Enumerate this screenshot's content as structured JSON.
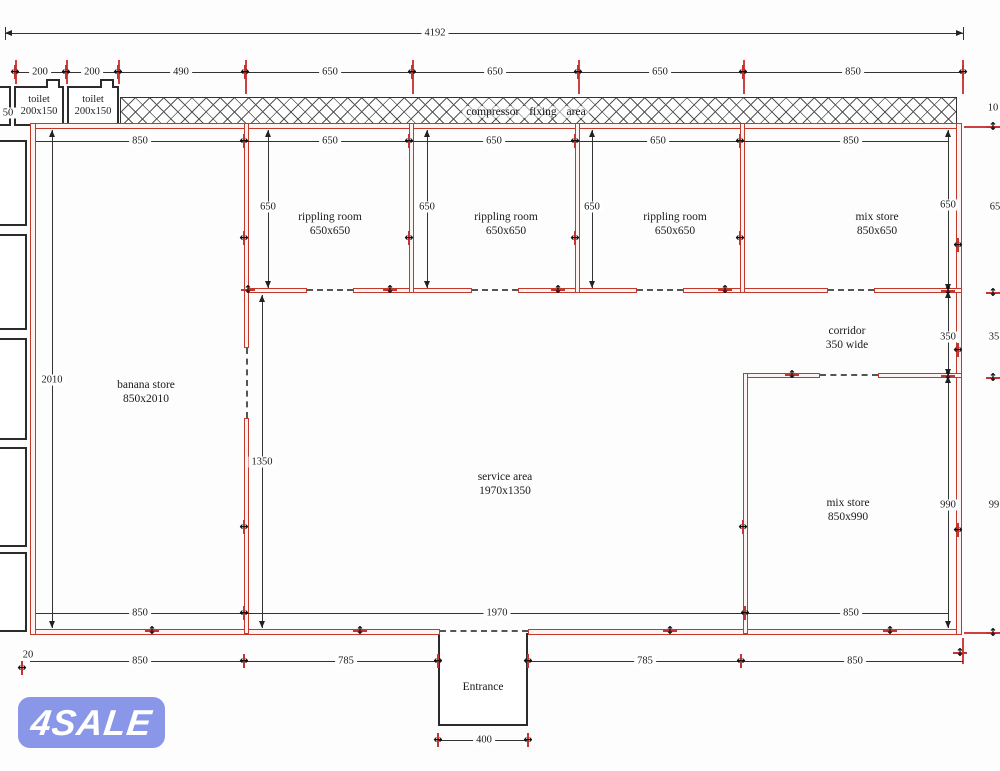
{
  "labels": {
    "compressor_area": "compressor  fixing  area",
    "entrance": "Entrance",
    "toilet_name": "toilet",
    "toilet_size": "200x150"
  },
  "rooms": [
    {
      "id": "rippling-room-1",
      "name": "rippling room",
      "size": "650x650",
      "cx": 330,
      "cy": 224
    },
    {
      "id": "rippling-room-2",
      "name": "rippling room",
      "size": "650x650",
      "cx": 506,
      "cy": 224
    },
    {
      "id": "rippling-room-3",
      "name": "rippling room",
      "size": "650x650",
      "cx": 675,
      "cy": 224
    },
    {
      "id": "mix-store-top",
      "name": "mix store",
      "size": "850x650",
      "cx": 877,
      "cy": 224
    },
    {
      "id": "corridor",
      "name": "corridor",
      "size": "350 wide",
      "cx": 847,
      "cy": 338
    },
    {
      "id": "banana-store",
      "name": "banana store",
      "size": "850x2010",
      "cx": 146,
      "cy": 392
    },
    {
      "id": "service-area",
      "name": "service area",
      "size": "1970x1350",
      "cx": 505,
      "cy": 484
    },
    {
      "id": "mix-store-bottom",
      "name": "mix store",
      "size": "850x990",
      "cx": 848,
      "cy": 510
    }
  ],
  "dims_h": [
    {
      "label": "4192",
      "x1": 5,
      "x2": 963,
      "y": 33,
      "lx": 435,
      "arrows": true
    },
    {
      "label": "200",
      "x1": 15,
      "x2": 66,
      "y": 72,
      "lx": 40
    },
    {
      "label": "200",
      "x1": 66,
      "x2": 118,
      "y": 72,
      "lx": 92
    },
    {
      "label": "490",
      "x1": 118,
      "x2": 245,
      "y": 72,
      "lx": 181
    },
    {
      "label": "650",
      "x1": 245,
      "x2": 412,
      "y": 72,
      "lx": 330
    },
    {
      "label": "650",
      "x1": 412,
      "x2": 578,
      "y": 72,
      "lx": 495
    },
    {
      "label": "650",
      "x1": 578,
      "x2": 743,
      "y": 72,
      "lx": 660
    },
    {
      "label": "850",
      "x1": 743,
      "x2": 963,
      "y": 72,
      "lx": 853
    },
    {
      "label": "850",
      "x1": 36,
      "x2": 244,
      "y": 141,
      "lx": 140
    },
    {
      "label": "650",
      "x1": 244,
      "x2": 409,
      "y": 141,
      "lx": 330
    },
    {
      "label": "650",
      "x1": 409,
      "x2": 575,
      "y": 141,
      "lx": 494
    },
    {
      "label": "650",
      "x1": 575,
      "x2": 740,
      "y": 141,
      "lx": 658
    },
    {
      "label": "850",
      "x1": 740,
      "x2": 948,
      "y": 141,
      "lx": 851
    },
    {
      "label": "850",
      "x1": 36,
      "x2": 244,
      "y": 613,
      "lx": 140
    },
    {
      "label": "1970",
      "x1": 244,
      "x2": 745,
      "y": 613,
      "lx": 497
    },
    {
      "label": "850",
      "x1": 745,
      "x2": 948,
      "y": 613,
      "lx": 851
    },
    {
      "label": "850",
      "x1": 30,
      "x2": 244,
      "y": 661,
      "lx": 140
    },
    {
      "label": "785",
      "x1": 244,
      "x2": 438,
      "y": 661,
      "lx": 346
    },
    {
      "label": "785",
      "x1": 528,
      "x2": 741,
      "y": 661,
      "lx": 645
    },
    {
      "label": "850",
      "x1": 741,
      "x2": 963,
      "y": 661,
      "lx": 855
    },
    {
      "label": "400",
      "x1": 438,
      "x2": 528,
      "y": 740,
      "lx": 484
    }
  ],
  "dims_v": [
    {
      "label": "2010",
      "y1": 130,
      "y2": 628,
      "x": 52,
      "ly": 380,
      "arrows": true
    },
    {
      "label": "650",
      "y1": 130,
      "y2": 288,
      "x": 268,
      "ly": 207,
      "arrows": true
    },
    {
      "label": "650",
      "y1": 130,
      "y2": 288,
      "x": 427,
      "ly": 207,
      "arrows": true
    },
    {
      "label": "650",
      "y1": 130,
      "y2": 288,
      "x": 592,
      "ly": 207,
      "arrows": true
    },
    {
      "label": "1350",
      "y1": 295,
      "y2": 628,
      "x": 262,
      "ly": 462,
      "arrows": true
    },
    {
      "label": "650",
      "y1": 130,
      "y2": 291,
      "x": 948,
      "ly": 205,
      "arrows": true
    },
    {
      "label": "350",
      "y1": 291,
      "y2": 376,
      "x": 948,
      "ly": 337,
      "arrows": true
    },
    {
      "label": "990",
      "y1": 376,
      "y2": 628,
      "x": 948,
      "ly": 505,
      "arrows": true
    }
  ],
  "side_labels": [
    {
      "label": "50",
      "x": 8,
      "y": 113
    },
    {
      "label": "10",
      "x": 993,
      "y": 108
    },
    {
      "label": "65",
      "x": 995,
      "y": 207
    },
    {
      "label": "35",
      "x": 994,
      "y": 337
    },
    {
      "label": "99",
      "x": 994,
      "y": 505
    },
    {
      "label": "20",
      "x": 28,
      "y": 655
    }
  ],
  "watermark": {
    "text": "4SALE",
    "bg": "#8a96e8",
    "fg": "#ffffff"
  },
  "colors": {
    "wall_red": "#c0392b",
    "dim_black": "#2b2b2b",
    "tick_red": "#c63333"
  }
}
